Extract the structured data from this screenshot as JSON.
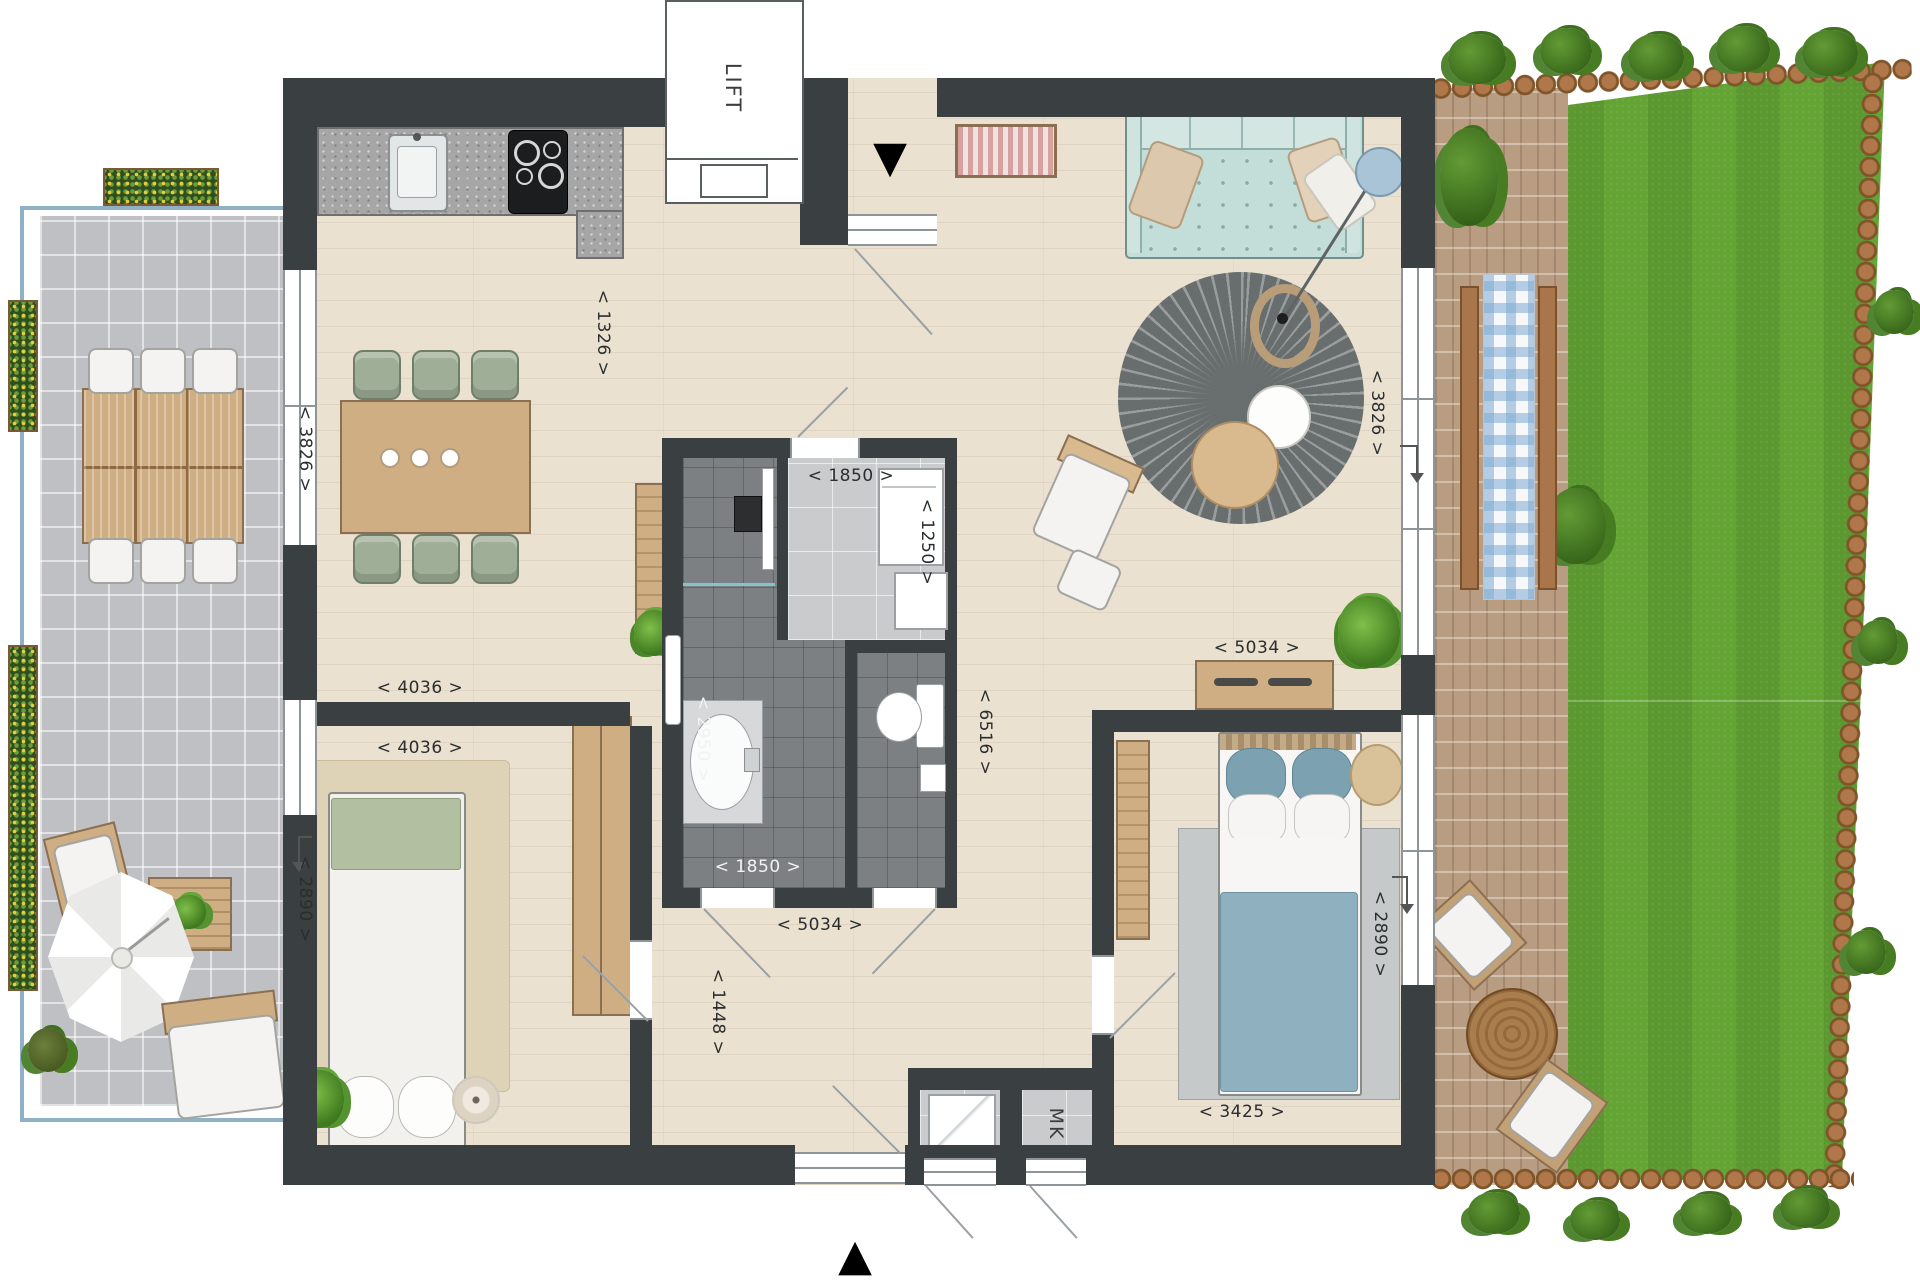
{
  "title": "apartment-floor-plan",
  "labels": {
    "lift": "LIFT",
    "mk": "MK"
  },
  "icons": {
    "entry_arrow_top": "▼",
    "entry_arrow_bottom": "▲"
  },
  "dimensions": {
    "kitchen_passage": "< 1326 >",
    "living_left_height": "< 3826 >",
    "dining_width": "< 4036 >",
    "bedroom1_width": "< 4036 >",
    "bedroom1_height": "< 2890 >",
    "bathroom_height": "< 2950 >",
    "storage_room_width": "< 1850 >",
    "storage_room_height": "< 1250 >",
    "bathroom_width": "< 1850 >",
    "hall_width": "< 5034 >",
    "hall_height": "< 1448 >",
    "corridor_length": "< 6516 >",
    "bedroom2_width": "< 5034 >",
    "living_right_height": "< 3826 >",
    "bedroom2_height": "< 2890 >",
    "bedroom2_bottom_width": "< 3425 >"
  },
  "colors": {
    "wall": "#3a3f41",
    "floor_wood": "#eae1d1",
    "bath_tile": "#7d8082",
    "tech_floor": "#c9cbcc",
    "terrace_tile": "#bfc0c4",
    "railing": "#8fb0c6",
    "grass": "#63a434",
    "brick_path": "#b99d82",
    "log_border": "#a9713f",
    "sofa": "#c3ddd8",
    "living_rug": "#6a6f70",
    "bed_blue": "#8fb0bf",
    "dining_chair": "#9fae97",
    "wood_furniture": "#cfae83",
    "bedroom1_rug": "#ded3b6"
  }
}
